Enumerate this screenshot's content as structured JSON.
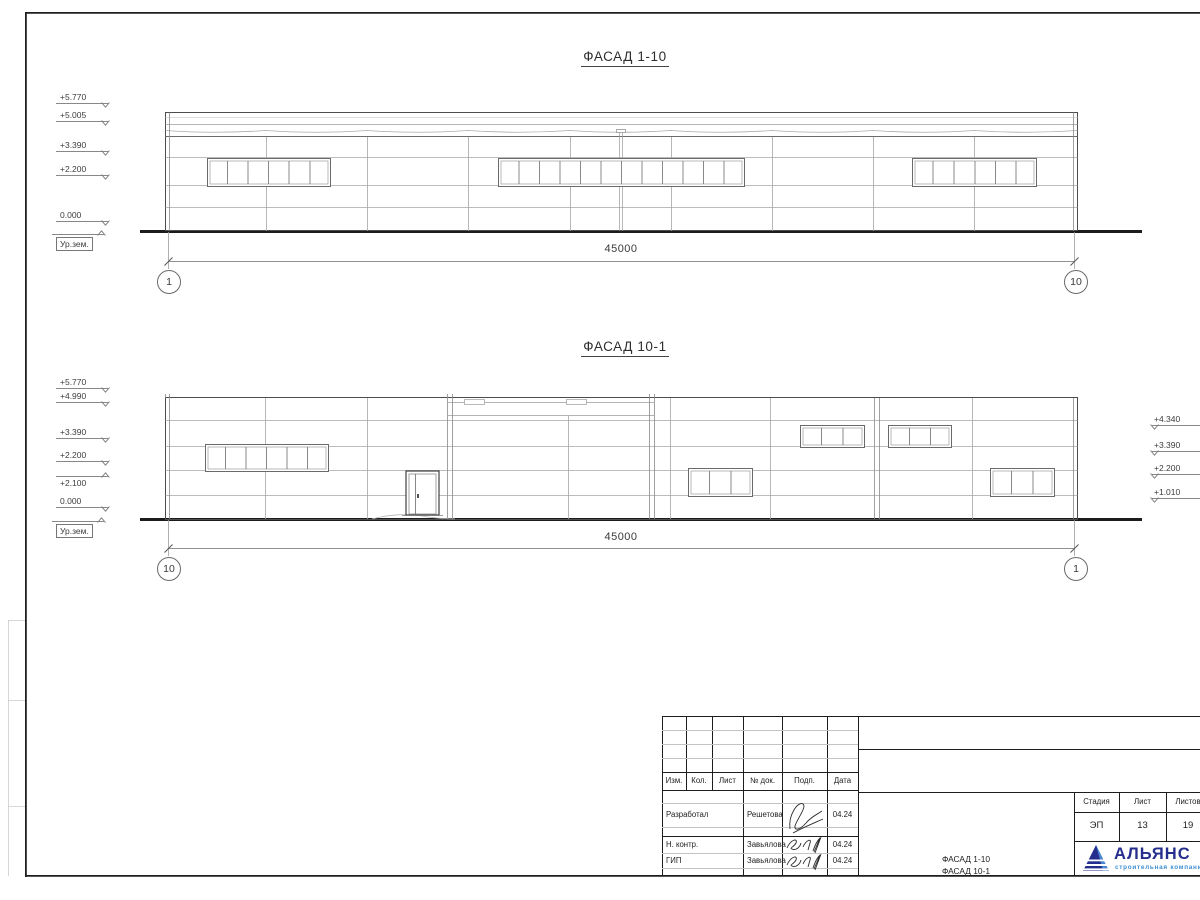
{
  "sheet": {
    "facade1": {
      "title": "ФАСАД 1-10",
      "dimension": "45000",
      "axis_left": "1",
      "axis_right": "10",
      "elevations_left": [
        {
          "label": "+5.770"
        },
        {
          "label": "+5.005"
        },
        {
          "label": "+3.390"
        },
        {
          "label": "+2.200"
        },
        {
          "label": "0.000"
        },
        {
          "label": "Ур.зем."
        }
      ]
    },
    "facade2": {
      "title": "ФАСАД 10-1",
      "dimension": "45000",
      "axis_left": "10",
      "axis_right": "1",
      "elevations_left": [
        {
          "label": "+5.770"
        },
        {
          "label": "+4.990"
        },
        {
          "label": "+3.390"
        },
        {
          "label": "+2.200"
        },
        {
          "label": "+2.100"
        },
        {
          "label": "0.000"
        },
        {
          "label": "Ур.зем."
        }
      ],
      "elevations_right": [
        {
          "label": "+4.340"
        },
        {
          "label": "+3.390"
        },
        {
          "label": "+2.200"
        },
        {
          "label": "+1.010"
        }
      ]
    },
    "title_block": {
      "header_cols": [
        "Изм.",
        "Кол.",
        "Лист",
        "№ док.",
        "Подп.",
        "Дата"
      ],
      "rows": [
        {
          "role": "Разработал",
          "name": "Решетова",
          "date": "04.24"
        },
        {
          "role": "Н. контр.",
          "name": "Завьялова",
          "date": "04.24"
        },
        {
          "role": "ГИП",
          "name": "Завьялова",
          "date": "04.24"
        }
      ],
      "doc_title_line1": "ФАСАД 1-10",
      "doc_title_line2": "ФАСАД 10-1",
      "stage_label": "Стадия",
      "sheet_label": "Лист",
      "sheets_label": "Листов",
      "stage_value": "ЭП",
      "sheet_value": "13",
      "sheets_value": "19",
      "logo": {
        "name": "АЛЬЯНС",
        "tagline": "строительная компания",
        "primary_color": "#252e8d",
        "accent_color": "#3f8fd2"
      }
    }
  }
}
